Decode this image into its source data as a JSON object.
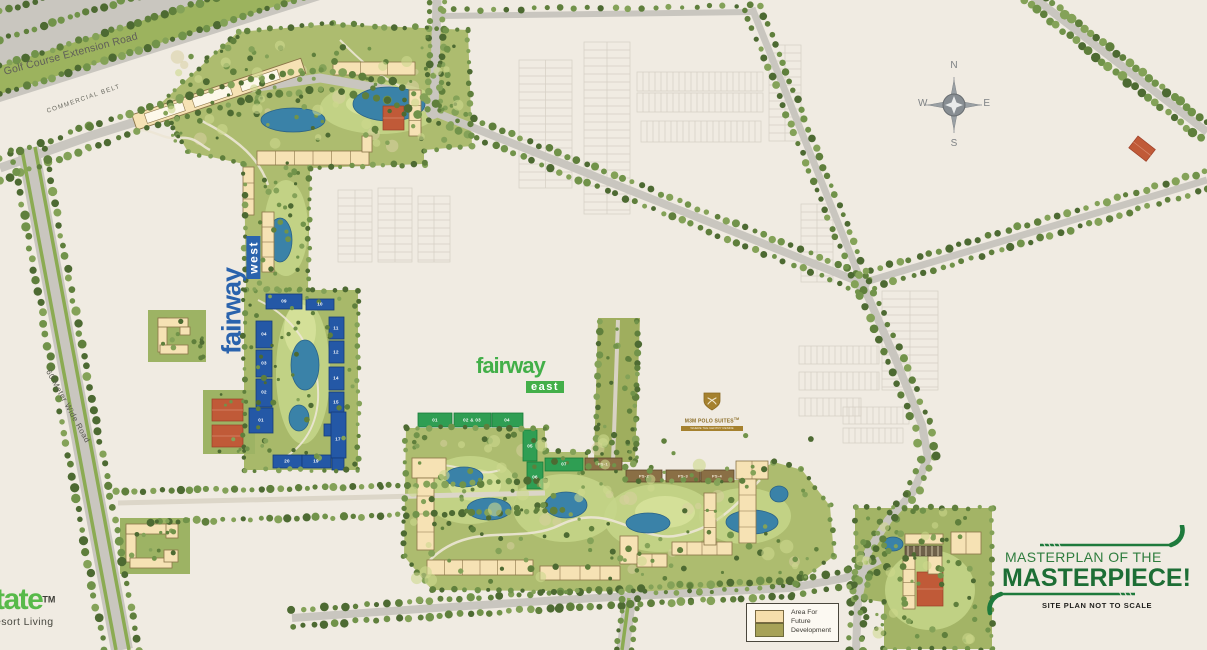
{
  "roads": {
    "golf_course_extension": "Golf Course Extension Road",
    "commercial_belt": "COMMERCIAL BELT",
    "sixty_meter": "60 Meter Wide Road"
  },
  "compass": {
    "n": "N",
    "e": "E",
    "s": "S",
    "w": "W"
  },
  "logos": {
    "fairway_west": {
      "word": "fairway",
      "sub": "west"
    },
    "fairway_east": {
      "word": "fairway",
      "sub": "east"
    },
    "polo": {
      "name": "M3M POLO SUITES",
      "tm": "TM",
      "tagline": "WHERE THE GENTRY RESIDE"
    },
    "estate": {
      "word": "tate",
      "tm": "TM",
      "tagline": "esort Living"
    }
  },
  "towers": {
    "west": [
      "04",
      "03",
      "02",
      "01",
      "09",
      "10",
      "11",
      "12",
      "14",
      "15",
      "17",
      "20",
      "19"
    ],
    "east": [
      "01",
      "02 & 03",
      "04",
      "05",
      "06",
      "07"
    ],
    "polo": [
      "PS-1",
      "PS-2",
      "PS-3",
      "PS-4"
    ]
  },
  "legend": {
    "text": "Area For Future Development"
  },
  "title_block": {
    "line1": "MASTERPLAN OF THE",
    "line2": "MASTERPIECE!",
    "line3": "SITE PLAN NOT TO SCALE"
  }
}
